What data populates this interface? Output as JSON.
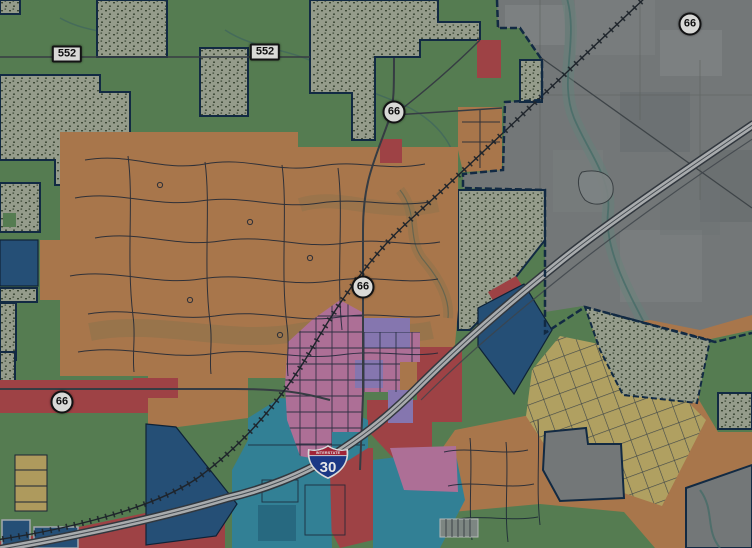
{
  "map": {
    "type": "municipal-zoning-web-map",
    "shields": {
      "route552": {
        "label": "552"
      },
      "route66": {
        "label": "66"
      },
      "interstate30": {
        "label": "30",
        "banner": "INTERSTATE"
      }
    },
    "zones": {
      "agriculture_green": "#68975f",
      "floodplain_stipple_bg": "#b7bfa8",
      "stipple_dot": "#49573d",
      "residential_orange": "#cf9058",
      "residential_yellow": "#d9c473",
      "yellow_parcel": "#d6bd6f",
      "commercial_teal": "#3d9cb4",
      "commercial_teal_dark": "#2f7f9a",
      "commercial_red": "#c25051",
      "downtown_pink": "#d587b5",
      "multifamily_purple": "#a490d4",
      "industrial_navy": "#2d5f8e",
      "unzoned_gray": "#8d9190",
      "boundary_navy": "#16324f",
      "street_line": "#1f2b3d",
      "road_gray": "#41484e",
      "water_teal": "#55837a",
      "water_wash": "#7aa093",
      "tan_wash": "#9d8a5c",
      "rail_dark": "#242a30",
      "freeway_fill": "#cfd2d2",
      "i30_blue": "#1d3e92",
      "i30_red": "#b3293b"
    }
  }
}
